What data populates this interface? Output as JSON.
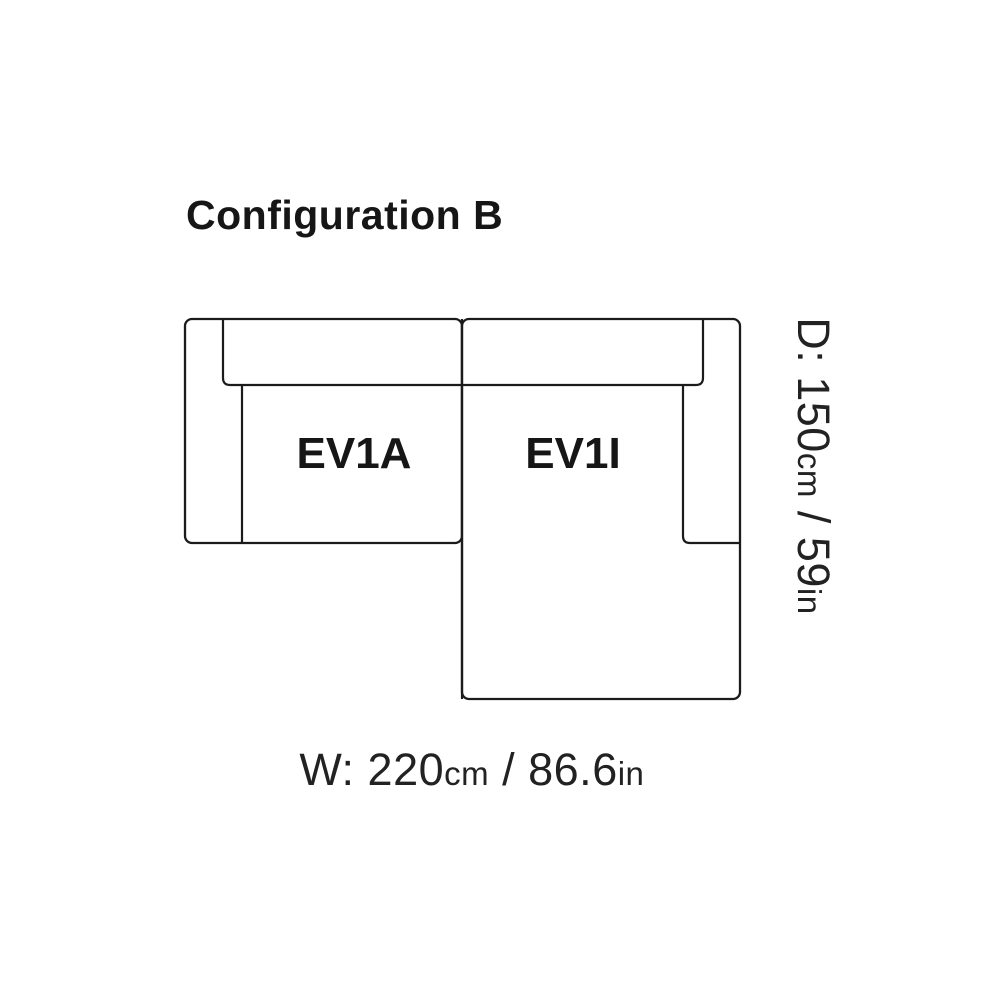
{
  "title": "Configuration B",
  "diagram": {
    "type": "sofa-top-view-configuration",
    "line_color": "#1b1b1b",
    "background_color": "#ffffff",
    "modules": [
      {
        "label": "EV1A",
        "position": "left"
      },
      {
        "label": "EV1I",
        "position": "right-with-chaise"
      }
    ],
    "dimension_labels": {
      "width": {
        "main": "W: 220",
        "unit_metric": "cm",
        "imperial": " / 86.6",
        "unit_imperial": "in"
      },
      "depth": {
        "main": "D: 150",
        "unit_metric": "cm",
        "imperial": " / 59",
        "unit_imperial": "in"
      }
    }
  }
}
